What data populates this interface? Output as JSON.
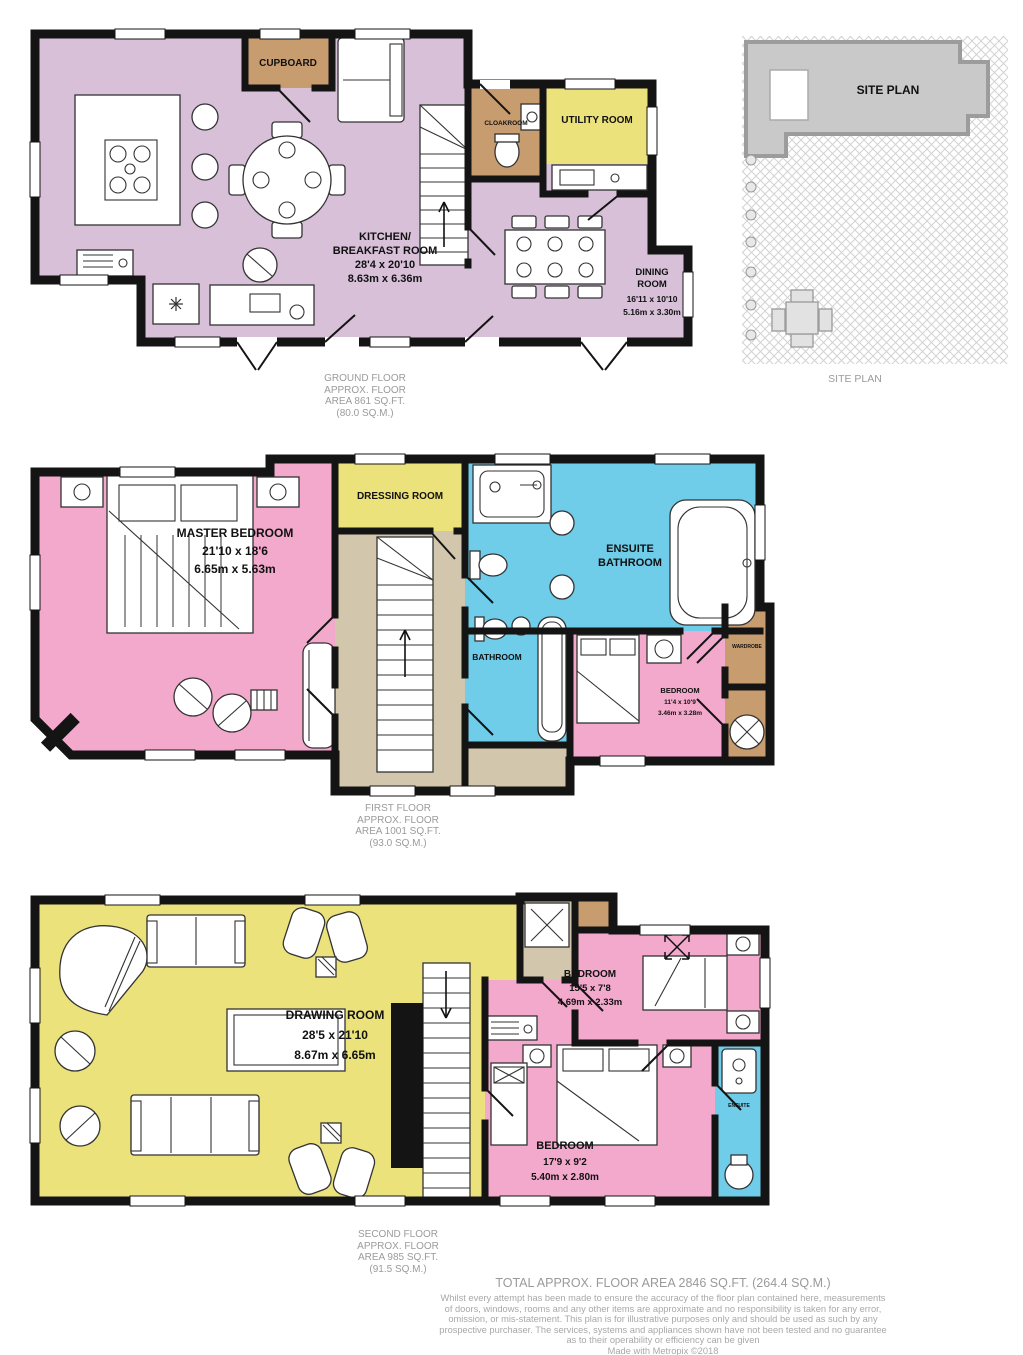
{
  "colors": {
    "kitchen_lilac": "#d7c0d8",
    "bedroom_pink": "#f3a9cc",
    "bathroom_blue": "#6fcde9",
    "room_yellow": "#ebe27b",
    "cupboard_tan": "#c79c6e",
    "landing_beige": "#d2c7ad",
    "wall_black": "#141414",
    "caption_gray": "#9b9b9b",
    "site_building_gray": "#c9c9c9"
  },
  "ground_floor": {
    "rooms": {
      "cupboard": {
        "label": "CUPBOARD"
      },
      "cloakroom": {
        "label": "CLOAKROOM"
      },
      "utility": {
        "label": "UTILITY ROOM"
      },
      "kitchen": {
        "name_line1": "KITCHEN/",
        "name_line2": "BREAKFAST ROOM",
        "dims_ft": "28'4 x 20'10",
        "dims_m": "8.63m x 6.36m"
      },
      "dining": {
        "name_line1": "DINING",
        "name_line2": "ROOM",
        "dims_ft": "16'11 x 10'10",
        "dims_m": "5.16m x 3.30m"
      }
    },
    "caption": {
      "line1": "GROUND FLOOR",
      "line2": "APPROX. FLOOR",
      "line3": "AREA 861 SQ.FT.",
      "line4": "(80.0 SQ.M.)"
    }
  },
  "site_plan": {
    "building_label": "SITE PLAN",
    "caption": "SITE PLAN"
  },
  "first_floor": {
    "rooms": {
      "master_bedroom": {
        "name": "MASTER BEDROOM",
        "dims_ft": "21'10 x 18'6",
        "dims_m": "6.65m x 5.63m"
      },
      "dressing_room": {
        "label": "DRESSING ROOM"
      },
      "ensuite_bathroom": {
        "name_line1": "ENSUITE",
        "name_line2": "BATHROOM"
      },
      "bathroom": {
        "label": "BATHROOM"
      },
      "bedroom": {
        "name": "BEDROOM",
        "dims_ft": "11'4 x 10'9",
        "dims_m": "3.46m x 3.28m"
      },
      "wardrobe": {
        "label": "WARDROBE"
      }
    },
    "caption": {
      "line1": "FIRST FLOOR",
      "line2": "APPROX. FLOOR",
      "line3": "AREA 1001 SQ.FT.",
      "line4": "(93.0 SQ.M.)"
    }
  },
  "second_floor": {
    "rooms": {
      "drawing_room": {
        "name": "DRAWING ROOM",
        "dims_ft": "28'5 x 21'10",
        "dims_m": "8.67m x 6.65m"
      },
      "bedroom_top": {
        "name": "BEDROOM",
        "dims_ft": "15'5 x 7'8",
        "dims_m": "4.69m x 2.33m"
      },
      "bedroom_bottom": {
        "name": "BEDROOM",
        "dims_ft": "17'9 x 9'2",
        "dims_m": "5.40m x 2.80m"
      },
      "ensuite": {
        "label": "ENSUITE"
      }
    },
    "caption": {
      "line1": "SECOND FLOOR",
      "line2": "APPROX. FLOOR",
      "line3": "AREA 985 SQ.FT.",
      "line4": "(91.5 SQ.M.)"
    }
  },
  "footer": {
    "total": "TOTAL APPROX. FLOOR AREA 2846 SQ.FT. (264.4 SQ.M.)",
    "disclaimer_line1": "Whilst every attempt has been made to ensure the accuracy of the floor plan contained here, measurements",
    "disclaimer_line2": "of doors, windows, rooms and any other items are approximate and no responsibility is taken for any error,",
    "disclaimer_line3": "omission, or mis-statement. This plan is for illustrative purposes only and should be used as such by any",
    "disclaimer_line4": "prospective purchaser. The services, systems and appliances shown have not been tested and no guarantee",
    "disclaimer_line5": "as to their operability or efficiency can be given",
    "made_with": "Made with Metropix ©2018"
  }
}
